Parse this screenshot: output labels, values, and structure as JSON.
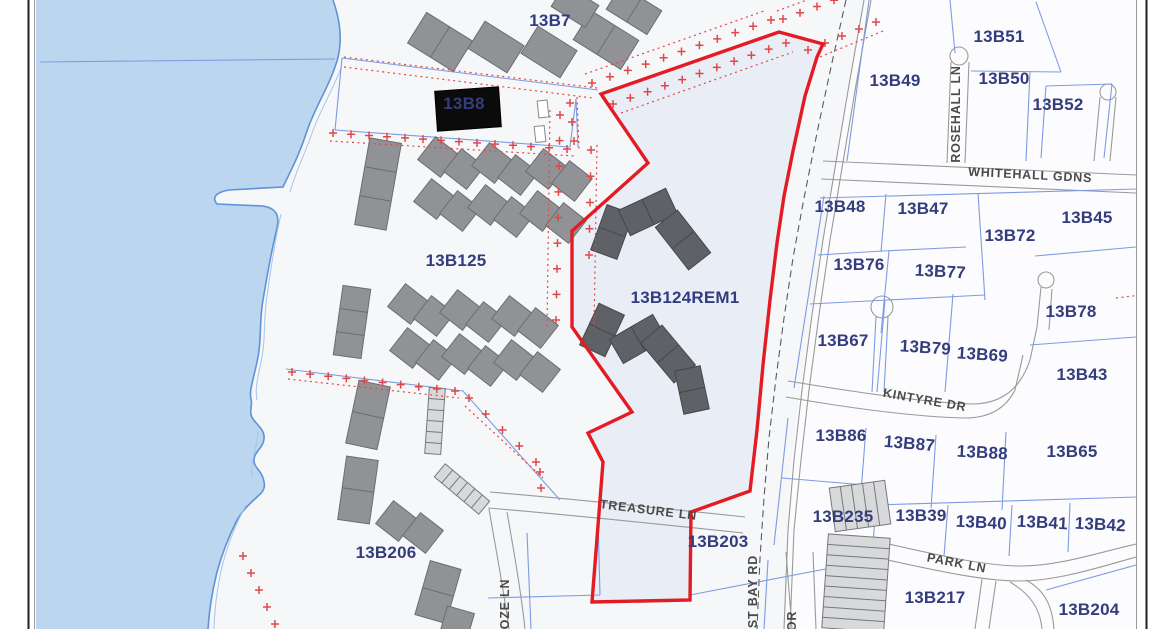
{
  "map": {
    "description": "GIS cadastral parcel map with waterfront, roads and a highlighted parcel",
    "highlighted_parcel": "13B124REM1",
    "colors": {
      "water": "#BCD6EF",
      "land": "#F6F7F9",
      "land_east": "#FCFCFE",
      "highlight_fill": "#E9EEF6",
      "boundary_red": "#E31B23",
      "marker_red": "#E04848",
      "parcel_line": "#7D9BE3",
      "parcel_label": "#333D7D",
      "street_label": "#4A4A4A",
      "road_edge": "#9A9A9A",
      "building": "#909296",
      "building_dark": "#5E6165",
      "building_black": "#0B0B0B",
      "building_hatched": "#D8D9DB",
      "frame_border": "#1F1F1F"
    },
    "parcel_labels": [
      {
        "text": "13B7",
        "x": 550,
        "y": 26
      },
      {
        "text": "13B8",
        "x": 464,
        "y": 109
      },
      {
        "text": "13B51",
        "x": 999,
        "y": 42
      },
      {
        "text": "13B49",
        "x": 895,
        "y": 86
      },
      {
        "text": "13B50",
        "x": 1004,
        "y": 84
      },
      {
        "text": "13B52",
        "x": 1058,
        "y": 110
      },
      {
        "text": "13B48",
        "x": 840,
        "y": 212
      },
      {
        "text": "13B47",
        "x": 923,
        "y": 214
      },
      {
        "text": "13B72",
        "x": 1010,
        "y": 241
      },
      {
        "text": "13B45",
        "x": 1087,
        "y": 223
      },
      {
        "text": "13B76",
        "x": 859,
        "y": 270
      },
      {
        "text": "13B77",
        "x": 940,
        "y": 277,
        "rot": 3
      },
      {
        "text": "13B78",
        "x": 1071,
        "y": 317
      },
      {
        "text": "13B67",
        "x": 843,
        "y": 346
      },
      {
        "text": "13B79",
        "x": 925,
        "y": 353,
        "rot": 4
      },
      {
        "text": "13B69",
        "x": 982,
        "y": 360,
        "rot": 4
      },
      {
        "text": "13B43",
        "x": 1082,
        "y": 380
      },
      {
        "text": "13B125",
        "x": 456,
        "y": 266
      },
      {
        "text": "13B124REM1",
        "x": 685,
        "y": 303
      },
      {
        "text": "13B86",
        "x": 841,
        "y": 441
      },
      {
        "text": "13B87",
        "x": 909,
        "y": 449,
        "rot": 5
      },
      {
        "text": "13B88",
        "x": 982,
        "y": 458,
        "rot": 3
      },
      {
        "text": "13B65",
        "x": 1072,
        "y": 457
      },
      {
        "text": "13B235",
        "x": 843,
        "y": 522
      },
      {
        "text": "13B39",
        "x": 921,
        "y": 521
      },
      {
        "text": "13B40",
        "x": 981,
        "y": 528,
        "rot": 3
      },
      {
        "text": "13B41",
        "x": 1042,
        "y": 528,
        "rot": 3
      },
      {
        "text": "13B42",
        "x": 1100,
        "y": 530,
        "rot": 3
      },
      {
        "text": "13B203",
        "x": 718,
        "y": 547
      },
      {
        "text": "13B206",
        "x": 386,
        "y": 558
      },
      {
        "text": "13B217",
        "x": 935,
        "y": 603
      },
      {
        "text": "13B204",
        "x": 1089,
        "y": 615
      }
    ],
    "street_labels": [
      {
        "text": "ROSEHALL LN",
        "x": 960,
        "y": 114,
        "rot": -90
      },
      {
        "text": "WHITEHALL GDNS",
        "x": 1030,
        "y": 179,
        "rot": 3
      },
      {
        "text": "KINTYRE DR",
        "x": 924,
        "y": 404,
        "rot": 10
      },
      {
        "text": "TREASURE LN",
        "x": 648,
        "y": 514,
        "rot": 7
      },
      {
        "text": "PARK LN",
        "x": 956,
        "y": 567,
        "rot": 11
      },
      {
        "text": "EAST BAY RD",
        "x": 757,
        "y": 601,
        "rot": -90
      },
      {
        "text": "OZE LN",
        "x": 509,
        "y": 604,
        "rot": -90
      },
      {
        "text": "OR",
        "x": 796,
        "y": 621,
        "rot": -90
      }
    ]
  }
}
